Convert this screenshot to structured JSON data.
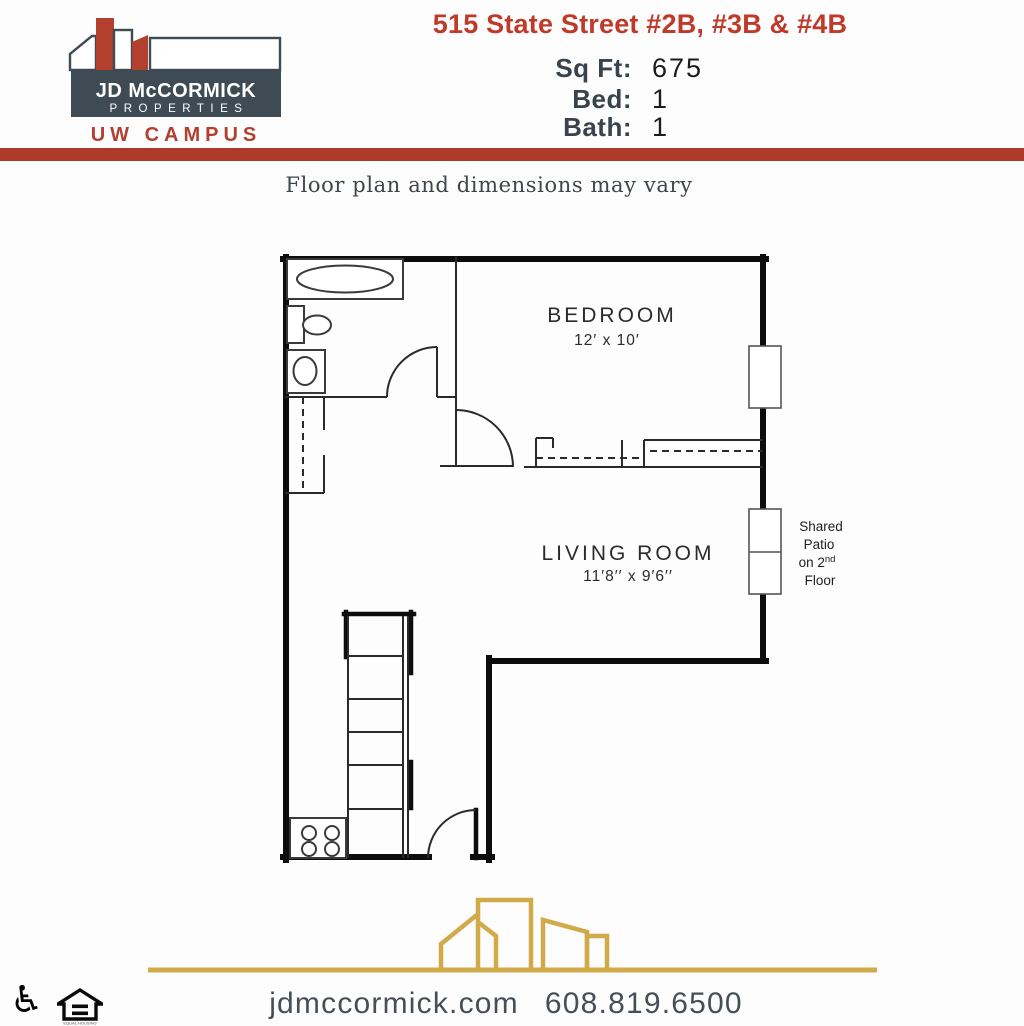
{
  "header": {
    "logo": {
      "company_line1": "JD McCORMICK",
      "company_line2": "PROPERTIES",
      "region": "UW CAMPUS"
    },
    "title": "515 State Street #2B, #3B & #4B",
    "stats": [
      {
        "label": "Sq Ft:",
        "value": "675"
      },
      {
        "label": "Bed:",
        "value": "1"
      },
      {
        "label": "Bath:",
        "value": "1"
      }
    ]
  },
  "notice": "Floor plan and dimensions may vary",
  "floorplan": {
    "bedroom": {
      "name": "BEDROOM",
      "dims": "12′ x 10′"
    },
    "living_room": {
      "name": "LIVING ROOM",
      "dims": "11′8′′ x 9′6′′"
    },
    "patio_label": {
      "line1": "Shared",
      "line2": "Patio",
      "line3_pre": "on 2",
      "line3_sup": "nd",
      "line4": "Floor"
    }
  },
  "footer": {
    "website": "jdmccormick.com",
    "phone": "608.819.6500",
    "wheelchair_icon_glyph": "♿",
    "equal_housing_caption": "EQUAL HOUSING"
  },
  "colors": {
    "accent_red": "#c03a2a",
    "divider_red": "#ad3a29",
    "logo_red": "#b3402e",
    "slate": "#3e4a54",
    "gold": "#d1ab4a"
  }
}
